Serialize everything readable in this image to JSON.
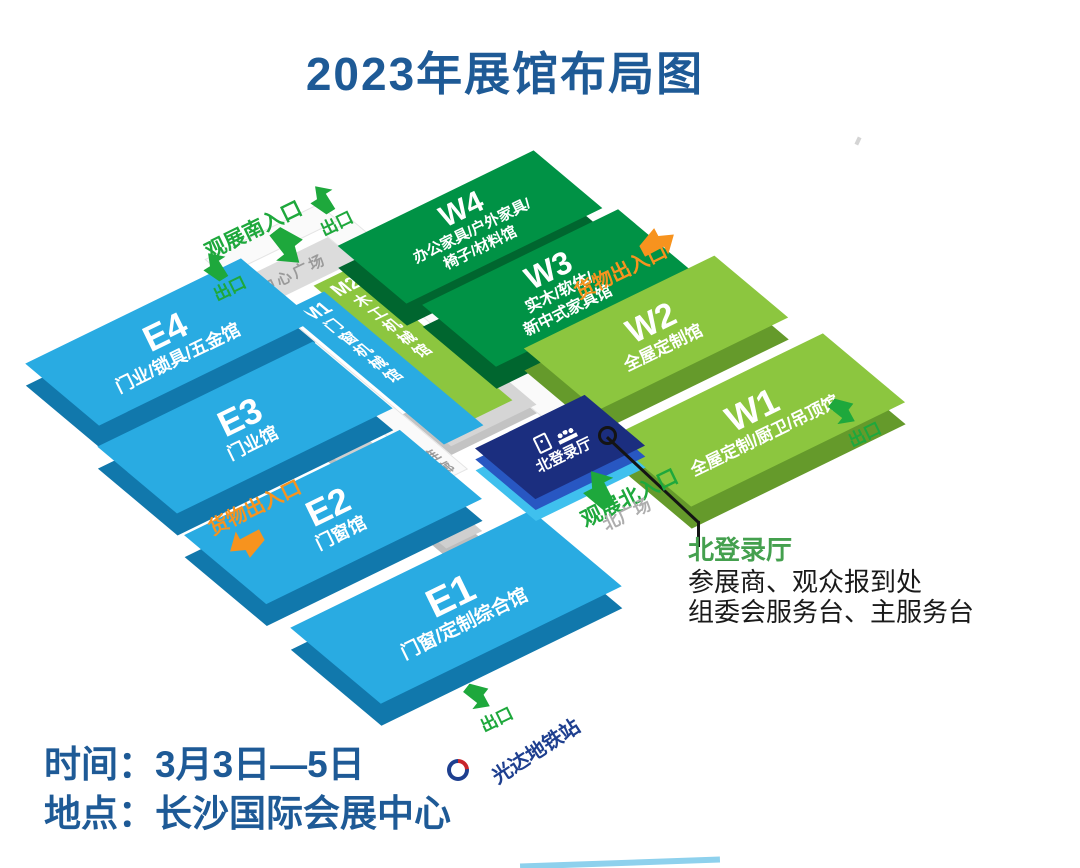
{
  "title": "2023年展馆布局图",
  "halls": {
    "e1": {
      "id": "E1",
      "name": "门窗/定制综合馆"
    },
    "e2": {
      "id": "E2",
      "name": "门窗馆"
    },
    "e3": {
      "id": "E3",
      "name": "门业馆"
    },
    "e4": {
      "id": "E4",
      "name": "门业/锁具/五金馆"
    },
    "w1": {
      "id": "W1",
      "name": "全屋定制/厨卫/吊顶馆"
    },
    "w2": {
      "id": "W2",
      "name": "全屋定制馆"
    },
    "w3": {
      "id": "W3",
      "name1": "实木/软体/",
      "name2": "新中式家具馆"
    },
    "w4": {
      "id": "W4",
      "name1": "办公家具/户外家具/",
      "name2": "椅子/材料馆"
    },
    "m1": {
      "id": "M1",
      "name": "门窗机械馆"
    },
    "m2": {
      "id": "M2",
      "name": "木工机械馆"
    },
    "north_hall": {
      "name": "北登录厅"
    }
  },
  "areas": {
    "central_plaza": "中心广场",
    "north_plaza": "北广场",
    "corridor": "连廊"
  },
  "gates": {
    "south_entrance": "观展南入口",
    "north_entrance": "观展北入口",
    "cargo_gate": "货物出入口",
    "exit": "出口"
  },
  "metro": {
    "station": "光达地铁站"
  },
  "callout": {
    "title": "北登录厅",
    "line1": "参展商、观众报到处",
    "line2": "组委会服务台、主服务台"
  },
  "footer": {
    "time": "时间：3月3日—5日",
    "venue": "地点：长沙国际会展中心"
  },
  "colors": {
    "blue_hall": "#29ABE2",
    "dark_green_hall": "#009245",
    "light_green_hall": "#8CC63F",
    "navy_hall": "#1B2E7F",
    "accent_green": "#1EA83C",
    "accent_orange": "#F7931E",
    "title_blue": "#1E5A96",
    "plaza_gray": "#DCDCDC"
  }
}
